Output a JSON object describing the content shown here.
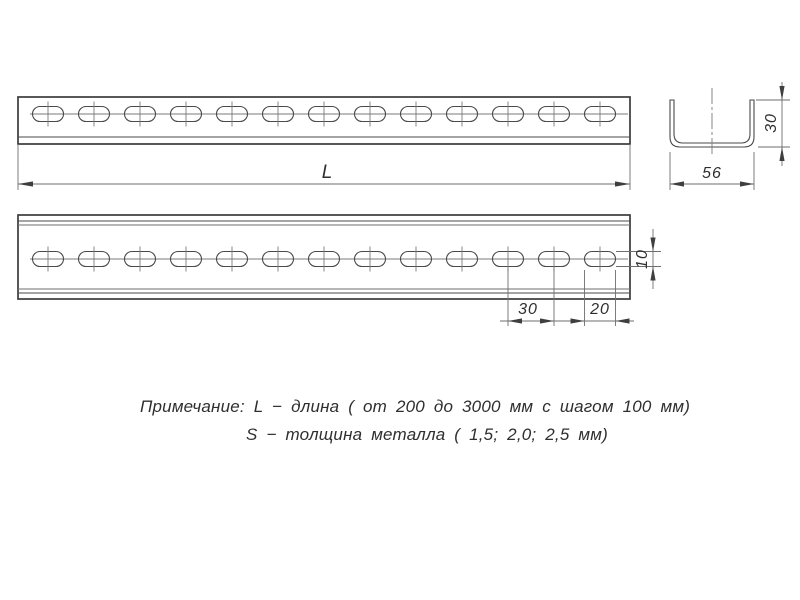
{
  "drawing_title": "Perforated U-channel technical drawing",
  "dimensions": {
    "length_label": "L",
    "section_width": "56",
    "section_height": "30",
    "hole_pitch": "30",
    "slot_length": "20",
    "slot_height": "10"
  },
  "note": {
    "line1": "Примечание: L − длина ( от 200 до 3000 мм с шагом 100 мм)",
    "line2": "S − толщина металла ( 1,5; 2,0; 2,5 мм)"
  },
  "drawing": {
    "slot_count": 13,
    "first_center_x": 48,
    "pitch_px": 46,
    "slot_length_px": 31,
    "slot_height_px": 15,
    "views": [
      {
        "center_y": 114
      },
      {
        "center_y": 259
      }
    ]
  },
  "colors": {
    "line_dark": "#3b3b3b",
    "line_medium": "#4a4a4a",
    "line_light": "#6e6e6e",
    "text": "#2f2f2f",
    "background": "#ffffff"
  }
}
